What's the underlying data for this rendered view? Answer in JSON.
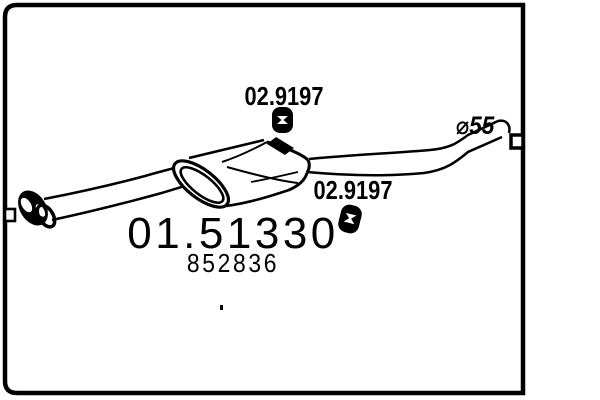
{
  "diagram": {
    "background": "#ffffff",
    "line_color": "#000000",
    "part": {
      "main_number": "01.51330",
      "secondary_number": "852836"
    },
    "mounts": {
      "top_label": "02.9197",
      "mid_label": "02.9197",
      "icon": "rubber-mount-icon"
    },
    "pipe": {
      "diameter_label": "⌀55"
    }
  }
}
